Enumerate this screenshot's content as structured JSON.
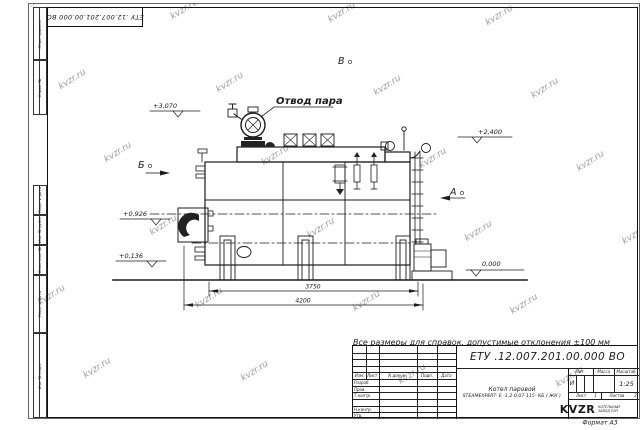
{
  "sheet": {
    "stamp_doc_number": "ЕТУ .12.007.201.00.000  ВО",
    "format_label": "Формат А3",
    "watermark": "kvzr.ru",
    "margins": {
      "perv_primen": "Перв. примен.",
      "sprav_no": "Справ. №",
      "podp_data_upper": "Подп. и дата",
      "inv_dubl": "Инв. № дубл.",
      "vzam_inv": "Взам. инв. №",
      "podp_data_lower": "Подп. и дата",
      "inv_podl": "Инв. № подл."
    }
  },
  "drawing": {
    "callout_steam_outlet": "Отвод пара",
    "view_b": "Б",
    "view_v": "В",
    "view_a": "А",
    "elev_3070": "+3,070",
    "elev_2400": "+2,400",
    "elev_0926": "+0,926",
    "elev_0136": "+0,136",
    "elev_0000": "0,000",
    "dim_3750": "3750",
    "dim_4200": "4200"
  },
  "title_block": {
    "note": "Все размеры для справок, допустимые отклонения  ±100 мм",
    "doc_number": "ЕТУ .12.007.201.00.000  ВО",
    "product_line1": "Котел паровой",
    "product_line2": "STEAMEXPERT- Е -1,2-0,07-115- КБ ( ЖК )",
    "col_izm": "Изм.",
    "col_list": "Лист",
    "col_ndokum": "N докум.",
    "col_podp": "Подп.",
    "col_data": "Дата",
    "row_razrab": "Разраб.",
    "row_prov": "Пров.",
    "row_tkontr": "Т.контр.",
    "row_nkontr": "Н.контр.",
    "row_utv": "Утв.",
    "hdr_lit": "Лит.",
    "hdr_massa": "Масса",
    "hdr_masshtab": "Масштаб",
    "lit_value": "И",
    "scale_value": "1:25",
    "sheet_label": "Лист",
    "sheet_value": "1",
    "sheets_label": "Листов",
    "sheets_value": "2",
    "logo_text": "KVZR",
    "company_line1": "КОТЕЛЬНЫЙ",
    "company_line2": "ЗАВОД РЭП"
  }
}
